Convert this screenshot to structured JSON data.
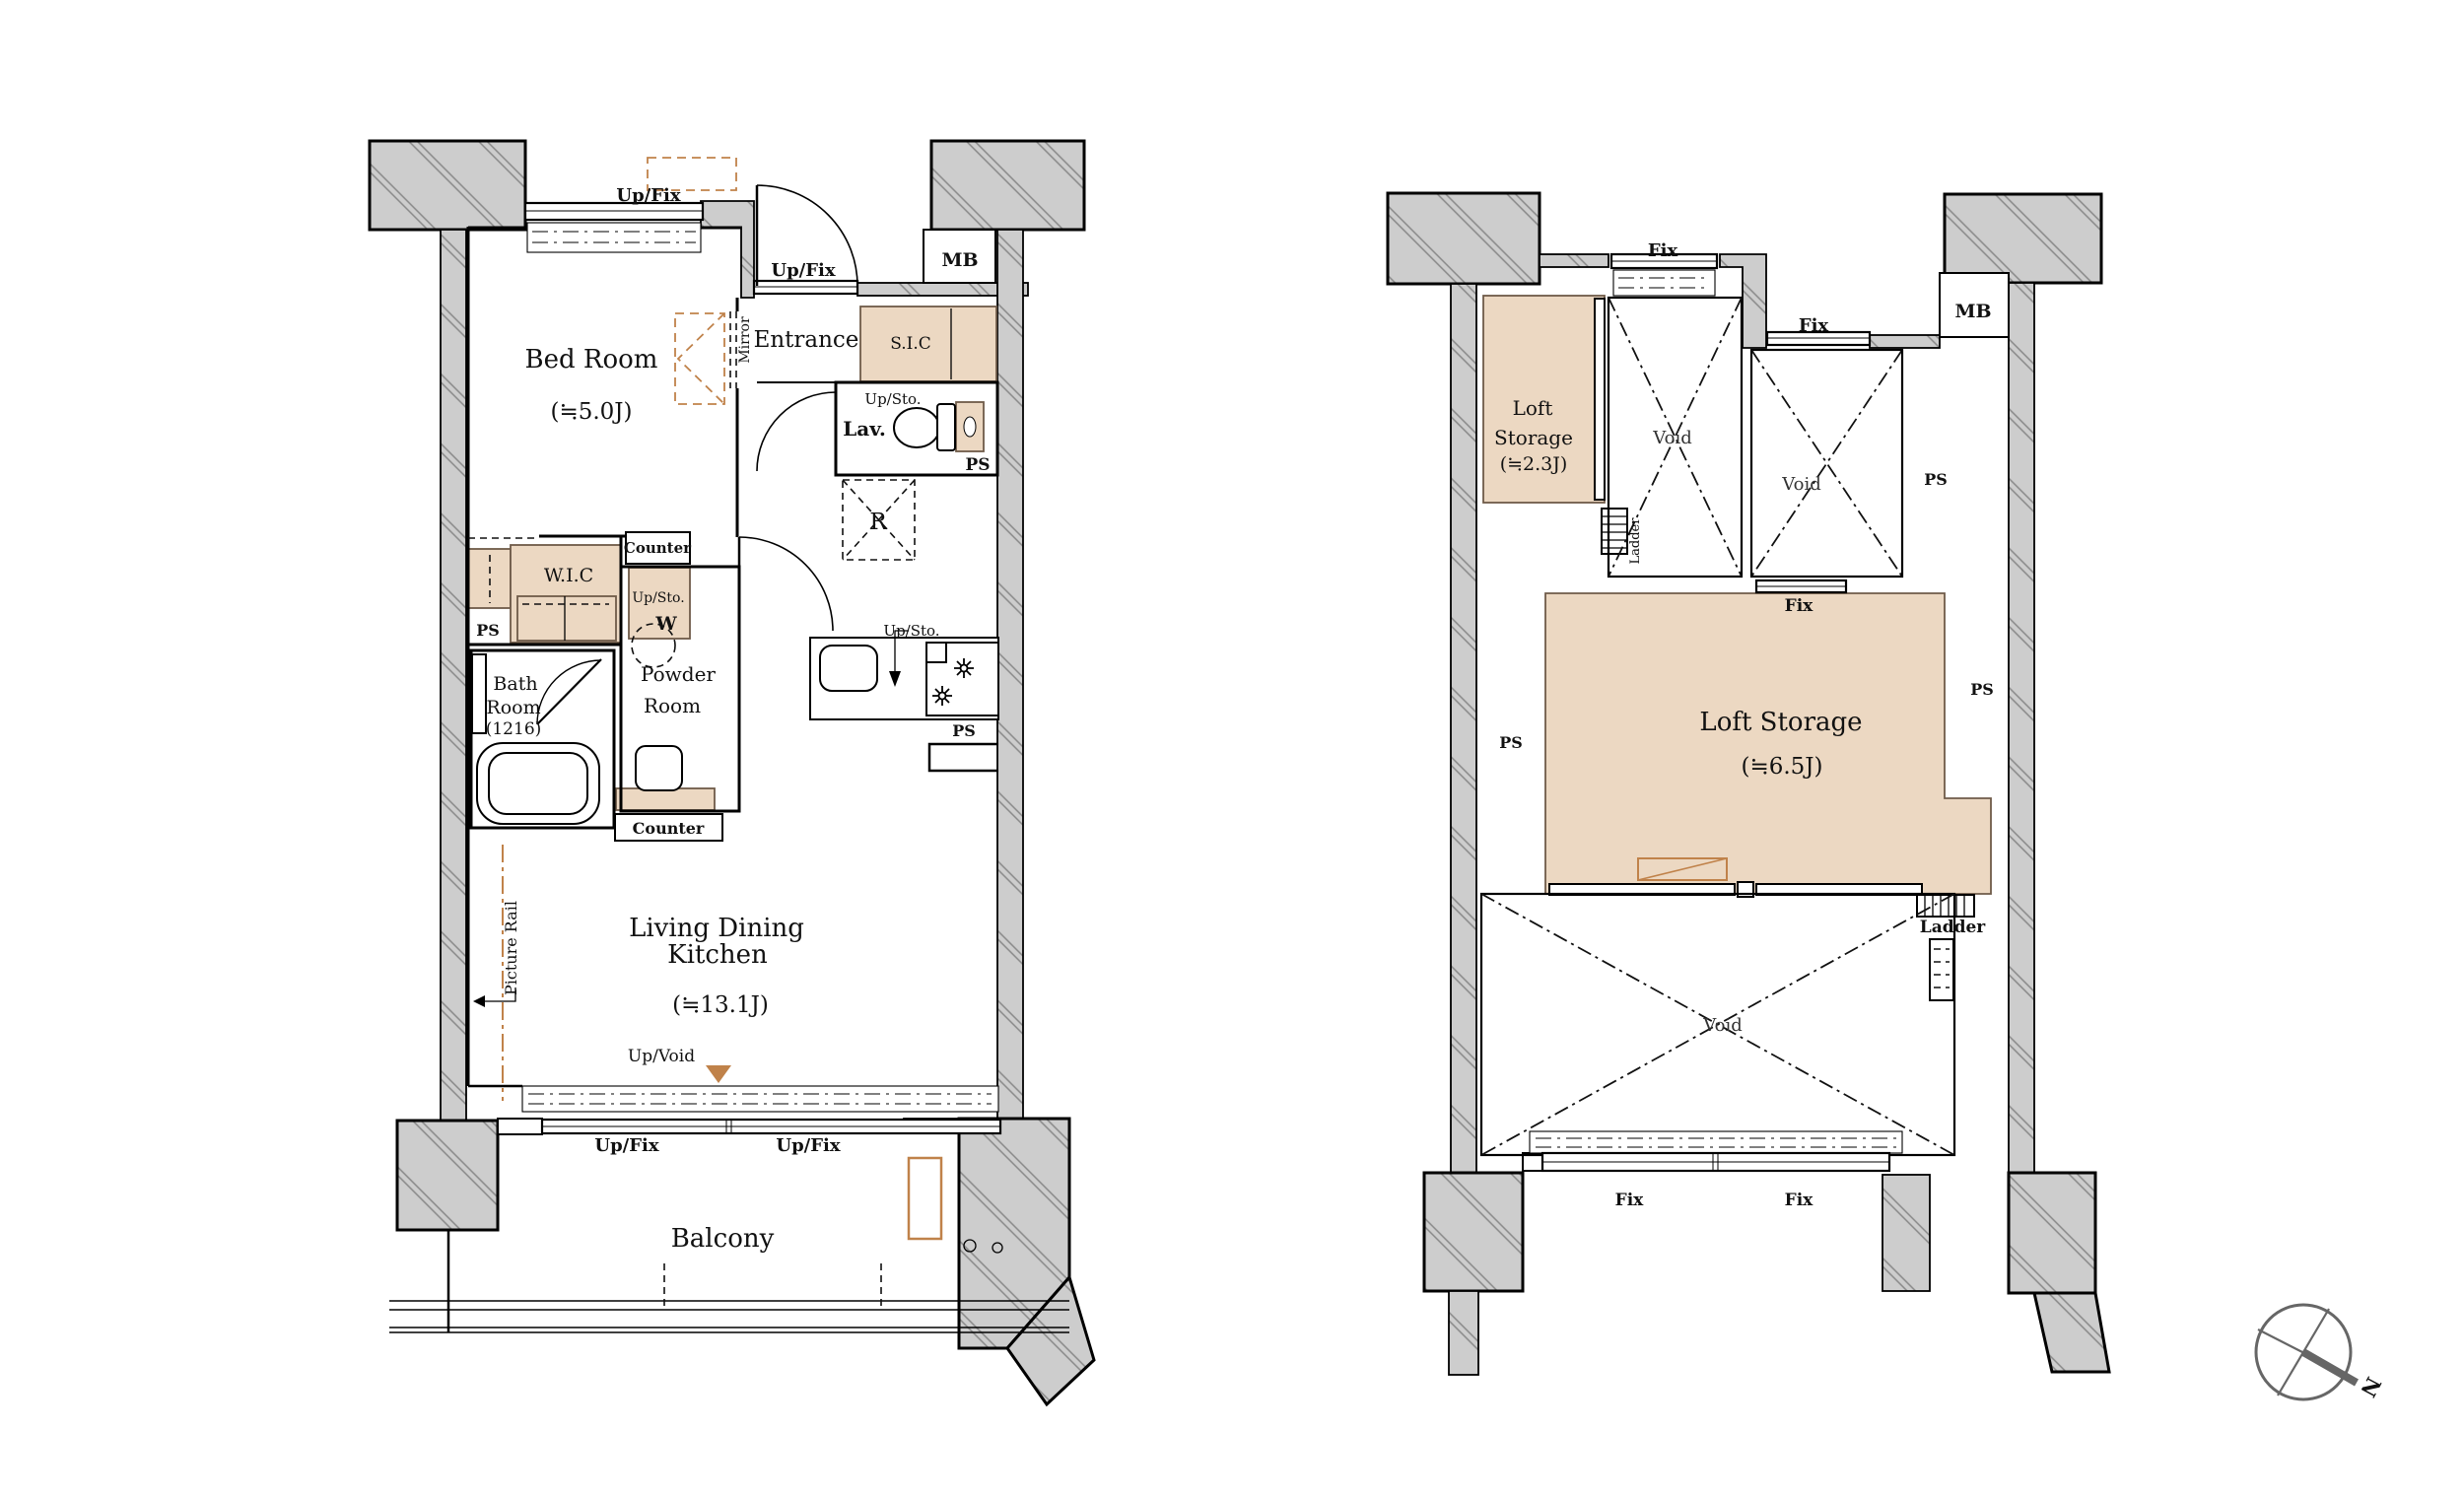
{
  "left_plan": {
    "rooms": {
      "bed_room_name": "Bed Room",
      "bed_room_size": "(≒5.0J)",
      "entrance": "Entrance",
      "sic": "S.I.C",
      "lav": "Lav.",
      "wic": "W.I.C",
      "bath_line1": "Bath",
      "bath_line2": "Room",
      "bath_size": "(1216)",
      "powder_line1": "Powder",
      "powder_line2": "Room",
      "ldk_line1": "Living Dining",
      "ldk_line2": "Kitchen",
      "ldk_size": "(≒13.1J)",
      "balcony": "Balcony"
    },
    "labels": {
      "up_fix": "Up/Fix",
      "up_sto": "Up/Sto.",
      "up_void": "Up/Void",
      "mb": "MB",
      "ps": "PS",
      "r": "R",
      "w": "W",
      "counter": "Counter",
      "mirror": "Mirror",
      "picture_rail": "Picture Rail"
    }
  },
  "right_plan": {
    "rooms": {
      "loft_small_line1": "Loft",
      "loft_small_line2": "Storage",
      "loft_small_size": "(≒2.3J)",
      "loft_big_name": "Loft Storage",
      "loft_big_size": "(≒6.5J)"
    },
    "labels": {
      "fix": "Fix",
      "void": "Void",
      "ps": "PS",
      "mb": "MB",
      "ladder": "Ladder"
    }
  },
  "compass": {
    "north": "N"
  },
  "colors": {
    "beige": "#ecd8c2",
    "orange": "#c0824a",
    "wall_gray": "#cdcdcd"
  }
}
